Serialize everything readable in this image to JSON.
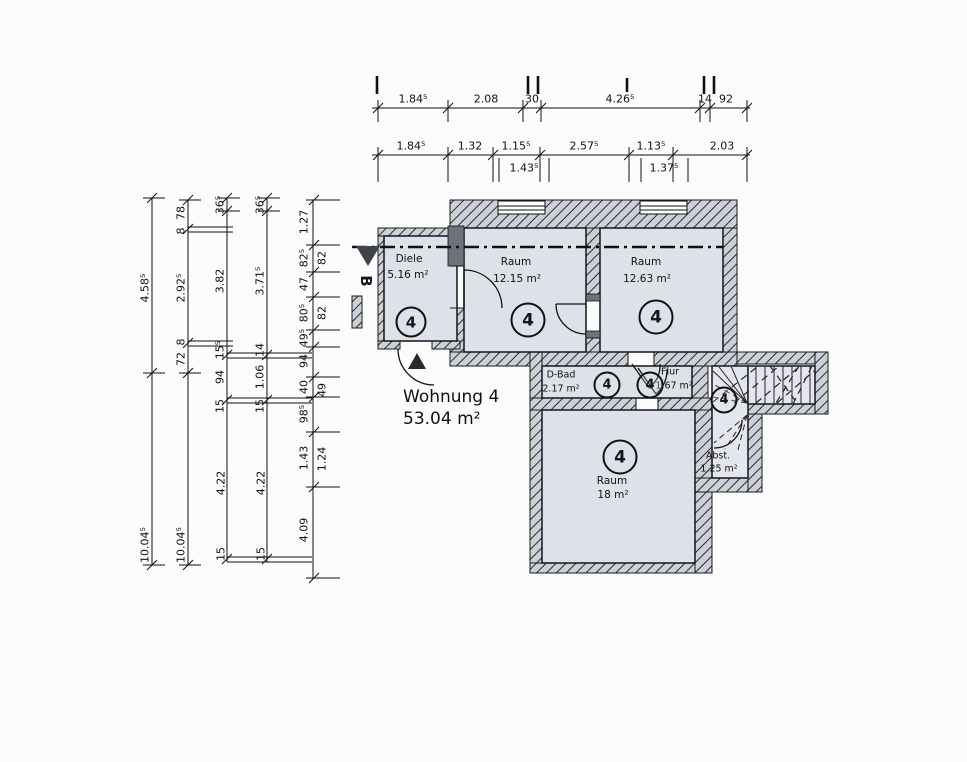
{
  "title": {
    "name": "Wohnung 4",
    "area": "53.04 m²"
  },
  "section_marker": "B",
  "rooms": {
    "diele": {
      "name": "Diele",
      "area": "5.16 m²",
      "unit": "4"
    },
    "raum1": {
      "name": "Raum",
      "area": "12.15 m²",
      "unit": "4"
    },
    "raum2": {
      "name": "Raum",
      "area": "12.63 m²",
      "unit": "4"
    },
    "dbad": {
      "name": "D-Bad",
      "area": "2.17 m²",
      "unit": "4"
    },
    "flur": {
      "name": "Flur",
      "area": "1.67 m²",
      "unit": "4"
    },
    "raum3": {
      "name": "Raum",
      "area": "18 m²",
      "unit": "4"
    },
    "abst": {
      "name": "Abst.",
      "area": "1.25 m²"
    },
    "stair_unit": "4"
  },
  "dims": {
    "row1": [
      "1.84⁵",
      "2.08",
      "30",
      "4.26⁵",
      "14",
      "92"
    ],
    "row2": [
      "1.84⁵",
      "1.32",
      "1.15⁵",
      "2.57⁵",
      "1.13⁵",
      "2.03"
    ],
    "row2sub": [
      "1.43⁵",
      "1.37⁵"
    ],
    "colA": [
      "4.58⁵",
      "10.04⁵"
    ],
    "colB": [
      "78",
      "8",
      "2.92⁵",
      "8",
      "72",
      "10.04⁵"
    ],
    "colC": [
      "36⁵",
      "3.82",
      "15⁵",
      "94",
      "15",
      "4.22",
      "15"
    ],
    "colD": [
      "36⁵",
      "3.71⁵",
      "14",
      "1.06",
      "15",
      "4.22",
      "15"
    ],
    "colE": [
      "1.27",
      "82⁵",
      "47",
      "80⁵",
      "49⁵",
      "94",
      "40",
      "98⁵",
      "1.43",
      "4.09"
    ],
    "colEsub": [
      "82",
      "82",
      "49",
      "1.24"
    ]
  }
}
